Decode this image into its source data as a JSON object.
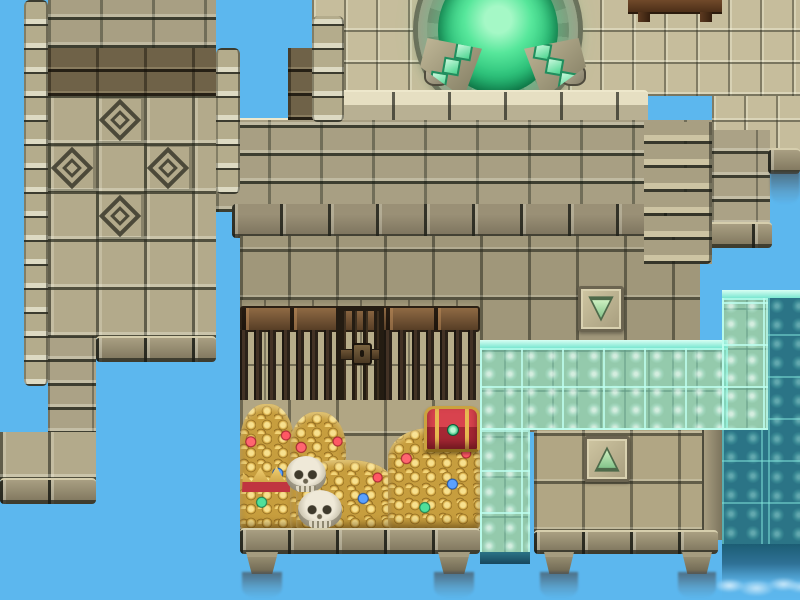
{
  "meta": {
    "scene_type": "rpg-tilemap-ruins",
    "viewport": {
      "width": 800,
      "height": 600
    },
    "tile_size": 48
  },
  "colors": {
    "sky": "#5cb7ee",
    "stone_light": "#c6bd9c",
    "stone_mid": "#a89f83",
    "stone_dark": "#6f6248",
    "wood_beam": "#7a5a38",
    "iron_bar": "#2a2118",
    "water_teal": "#6fe2c8",
    "water_deep": "#2b7486",
    "portal_green": "#2fc47c",
    "gold": "#e2b64d",
    "gem_red": "#e04550",
    "gem_blue": "#4a90e0",
    "gem_green": "#3ad189",
    "arrow_green": "#7fc187"
  },
  "legend": {
    "tilesLight": "light stone floor tiles (upper terrace)",
    "bricks": "stone brick wall",
    "bricksDark": "dark brown brick band",
    "bigTiles": "large square wall tiles",
    "diamondTile": "carved diamond motif tile",
    "roomWall": "sandstone cell wall",
    "floorTiles": "interior stone floor",
    "floorTiles2": "vault / platform floor",
    "woodBeam": "wooden beam above cell bars",
    "bars": "iron cell bars",
    "door": "barred cell door with lock",
    "treasure": "pile of gold coins and gems",
    "skull": "skeleton skull",
    "chest": "red and gold treasure chest",
    "crown": "golden crown",
    "plaque": "stone plaque with transfer arrow",
    "tealLight": "shallow water overlay on stone",
    "tealDark": "deep waterfall water",
    "portalRing": "carved stone portal ring",
    "portalPool": "glowing green portal pool",
    "wedge": "stone pedestal with green crystals",
    "foot": "stone support foot over the void",
    "mistDark": "falling mist"
  },
  "scene": [
    {
      "n": "upper-floor",
      "c": "tilesLight",
      "x": 312,
      "y": 0,
      "w": 488,
      "h": 96,
      "i": false
    },
    {
      "n": "upper-floor-right",
      "c": "tilesLight",
      "x": 712,
      "y": 96,
      "w": 88,
      "h": 58,
      "i": false
    },
    {
      "n": "banquet-table",
      "c": "tableTop",
      "x": 628,
      "y": 0,
      "w": 94,
      "h": 14,
      "i": false
    },
    {
      "n": "table-leg",
      "c": "tableLeg",
      "x": 638,
      "y": 12,
      "w": 12,
      "h": 10,
      "i": false
    },
    {
      "n": "table-leg",
      "c": "tableLeg",
      "x": 700,
      "y": 12,
      "w": 12,
      "h": 10,
      "i": false
    },
    {
      "n": "portal-ring",
      "c": "portalRing",
      "x": 418,
      "y": -54,
      "w": 160,
      "h": 168,
      "i": false
    },
    {
      "n": "portal-pool",
      "c": "portalPool",
      "x": 438,
      "y": -34,
      "w": 120,
      "h": 128,
      "i": true
    },
    {
      "n": "ring-stone",
      "c": "ringBlock",
      "x": 424,
      "y": 64,
      "w": 26,
      "h": 22,
      "i": false
    },
    {
      "n": "ring-stone",
      "c": "ringBlock",
      "x": 448,
      "y": 92,
      "w": 26,
      "h": 20,
      "i": false
    },
    {
      "n": "ring-stone",
      "c": "ringBlock",
      "x": 476,
      "y": 102,
      "w": 28,
      "h": 20,
      "i": false
    },
    {
      "n": "ring-stone",
      "c": "ringBlock",
      "x": 508,
      "y": 102,
      "w": 26,
      "h": 20,
      "i": false
    },
    {
      "n": "ring-stone",
      "c": "ringBlock",
      "x": 538,
      "y": 92,
      "w": 26,
      "h": 20,
      "i": false
    },
    {
      "n": "ring-stone",
      "c": "ringBlock",
      "x": 560,
      "y": 64,
      "w": 26,
      "h": 22,
      "i": false
    },
    {
      "n": "pedestal-left",
      "c": "wedge",
      "d": "left",
      "x": 420,
      "y": 38,
      "w": 62,
      "h": 60,
      "i": false
    },
    {
      "n": "pedestal-right",
      "c": "wedge",
      "d": "right",
      "x": 524,
      "y": 38,
      "w": 62,
      "h": 60,
      "i": false
    },
    {
      "n": "wall-cap",
      "c": "capRow",
      "x": 336,
      "y": 90,
      "w": 312,
      "h": 34,
      "i": false
    },
    {
      "n": "wall-cap-left",
      "c": "capRow",
      "x": 216,
      "y": 118,
      "w": 128,
      "h": 34,
      "i": false
    },
    {
      "n": "wall-bricks",
      "c": "bricks",
      "x": 216,
      "y": 120,
      "w": 496,
      "h": 92,
      "i": false
    },
    {
      "n": "wall-base-cap",
      "c": "darkCap",
      "x": 232,
      "y": 204,
      "w": 480,
      "h": 34,
      "i": false
    },
    {
      "n": "right-column",
      "c": "bricksSmall",
      "x": 712,
      "y": 130,
      "w": 58,
      "h": 96,
      "i": false
    },
    {
      "n": "right-column-ledge",
      "c": "ledgeRow",
      "x": 704,
      "y": 222,
      "w": 68,
      "h": 26,
      "i": false
    },
    {
      "n": "cliff-ledge",
      "c": "ledgeRow",
      "x": 768,
      "y": 148,
      "w": 32,
      "h": 26,
      "i": false
    },
    {
      "n": "ledge-mist",
      "c": "mistDark",
      "x": 770,
      "y": 172,
      "w": 30,
      "h": 32,
      "i": false
    },
    {
      "n": "wall-notch-column",
      "c": "bricksDark",
      "x": 288,
      "y": 48,
      "w": 26,
      "h": 72,
      "i": false
    },
    {
      "n": "terrace-left-trim",
      "c": "trimBlocks",
      "x": 312,
      "y": 16,
      "w": 32,
      "h": 106,
      "i": false
    },
    {
      "n": "room-floor",
      "c": "floorTiles",
      "x": 240,
      "y": 236,
      "w": 472,
      "h": 112,
      "i": false
    },
    {
      "n": "wall-stairs",
      "c": "stairs",
      "x": 644,
      "y": 122,
      "w": 68,
      "h": 142,
      "i": false
    },
    {
      "n": "sky-notch",
      "c": "sky",
      "x": 700,
      "y": 264,
      "w": 28,
      "h": 80,
      "i": false
    },
    {
      "n": "down-arrow-plaque",
      "c": "plaque",
      "d": "down",
      "x": 578,
      "y": 286,
      "w": 46,
      "h": 46,
      "i": true
    },
    {
      "n": "cell-wall",
      "c": "roomWall",
      "x": 240,
      "y": 300,
      "w": 240,
      "h": 106,
      "i": false
    },
    {
      "n": "cell-beam",
      "c": "woodBeam",
      "x": 240,
      "y": 306,
      "w": 240,
      "h": 26,
      "i": false
    },
    {
      "n": "cell-bars",
      "c": "bars",
      "x": 240,
      "y": 330,
      "w": 96,
      "h": 76,
      "i": false
    },
    {
      "n": "cell-bars",
      "c": "bars",
      "x": 384,
      "y": 330,
      "w": 96,
      "h": 76,
      "i": false
    },
    {
      "n": "cell-door",
      "c": "door",
      "x": 336,
      "y": 306,
      "w": 48,
      "h": 100,
      "i": true
    },
    {
      "n": "treasure-floor",
      "c": "floorTiles2",
      "x": 240,
      "y": 400,
      "w": 240,
      "h": 132,
      "i": false
    },
    {
      "n": "gold-pile",
      "c": "treasure",
      "x": 240,
      "y": 404,
      "w": 54,
      "h": 126,
      "i": false
    },
    {
      "n": "gold-pile",
      "c": "treasure",
      "x": 290,
      "y": 412,
      "w": 56,
      "h": 118,
      "i": false
    },
    {
      "n": "gold-pile",
      "c": "treasure",
      "x": 296,
      "y": 460,
      "w": 96,
      "h": 70,
      "i": false
    },
    {
      "n": "gold-pile",
      "c": "treasure",
      "x": 388,
      "y": 428,
      "w": 92,
      "h": 102,
      "i": false
    },
    {
      "n": "crown",
      "c": "crown",
      "x": 242,
      "y": 464,
      "w": 48,
      "h": 28,
      "i": false
    },
    {
      "n": "skull",
      "c": "skull",
      "x": 286,
      "y": 456,
      "w": 40,
      "h": 36,
      "i": false
    },
    {
      "n": "skull",
      "c": "skull",
      "x": 298,
      "y": 490,
      "w": 44,
      "h": 38,
      "i": false
    },
    {
      "n": "treasure-chest",
      "c": "chest",
      "x": 424,
      "y": 406,
      "w": 56,
      "h": 46,
      "i": true
    },
    {
      "n": "treasure-ledge",
      "c": "ledgeRow",
      "x": 240,
      "y": 528,
      "w": 240,
      "h": 26,
      "i": false
    },
    {
      "n": "support-foot",
      "c": "foot",
      "x": 246,
      "y": 552,
      "w": 32,
      "h": 22,
      "i": false
    },
    {
      "n": "support-foot",
      "c": "foot",
      "x": 438,
      "y": 552,
      "w": 32,
      "h": 22,
      "i": false
    },
    {
      "n": "falling-mist",
      "c": "mistDark",
      "x": 242,
      "y": 572,
      "w": 40,
      "h": 26,
      "i": false
    },
    {
      "n": "falling-mist",
      "c": "mistDark",
      "x": 434,
      "y": 572,
      "w": 40,
      "h": 26,
      "i": false
    },
    {
      "n": "water-backing",
      "c": "roomWall",
      "x": 480,
      "y": 344,
      "w": 248,
      "h": 88,
      "i": false
    },
    {
      "n": "water-backing",
      "c": "roomWall",
      "x": 480,
      "y": 430,
      "w": 50,
      "h": 128,
      "i": false
    },
    {
      "n": "water-backing",
      "c": "roomWall",
      "x": 722,
      "y": 298,
      "w": 46,
      "h": 132,
      "i": false
    },
    {
      "n": "water-sheet-edge",
      "c": "tealEdge",
      "x": 480,
      "y": 340,
      "w": 248,
      "h": 10,
      "i": false
    },
    {
      "n": "water-sheet",
      "c": "tealLight",
      "x": 480,
      "y": 348,
      "w": 248,
      "h": 82,
      "i": false
    },
    {
      "n": "water-column",
      "c": "tealLight",
      "x": 480,
      "y": 430,
      "w": 50,
      "h": 126,
      "i": false
    },
    {
      "n": "water-column-base",
      "c": "tealBottom",
      "x": 480,
      "y": 552,
      "w": 50,
      "h": 12,
      "i": false
    },
    {
      "n": "water-right-edge",
      "c": "tealEdge",
      "x": 722,
      "y": 290,
      "w": 78,
      "h": 10,
      "i": false
    },
    {
      "n": "water-right",
      "c": "tealLight",
      "x": 722,
      "y": 298,
      "w": 46,
      "h": 132,
      "i": false
    },
    {
      "n": "water-right-deep",
      "c": "tealDark",
      "x": 768,
      "y": 298,
      "w": 32,
      "h": 248,
      "i": false
    },
    {
      "n": "water-right-lower",
      "c": "tealDark",
      "x": 722,
      "y": 430,
      "w": 46,
      "h": 116,
      "i": false
    },
    {
      "n": "waterfall-mist",
      "c": "waterfallFade",
      "x": 722,
      "y": 544,
      "w": 78,
      "h": 56,
      "i": false
    },
    {
      "n": "ledge-platform",
      "c": "floorTiles2",
      "x": 534,
      "y": 430,
      "w": 184,
      "h": 102,
      "i": false
    },
    {
      "n": "up-arrow-plaque",
      "c": "plaque",
      "d": "up",
      "x": 584,
      "y": 436,
      "w": 46,
      "h": 46,
      "i": true
    },
    {
      "n": "platform-edge",
      "c": "stoneEdge",
      "x": 702,
      "y": 430,
      "w": 20,
      "h": 110,
      "i": false
    },
    {
      "n": "platform-ledge",
      "c": "ledgeRow",
      "x": 534,
      "y": 530,
      "w": 184,
      "h": 24,
      "i": false
    },
    {
      "n": "support-foot",
      "c": "foot",
      "x": 544,
      "y": 552,
      "w": 30,
      "h": 22,
      "i": false
    },
    {
      "n": "support-foot",
      "c": "foot",
      "x": 682,
      "y": 552,
      "w": 30,
      "h": 22,
      "i": false
    },
    {
      "n": "falling-mist",
      "c": "mistDark",
      "x": 540,
      "y": 572,
      "w": 38,
      "h": 26,
      "i": false
    },
    {
      "n": "falling-mist",
      "c": "mistDark",
      "x": 678,
      "y": 572,
      "w": 38,
      "h": 26,
      "i": false
    },
    {
      "n": "tower-left-trim",
      "c": "trimBlocks",
      "x": 24,
      "y": 0,
      "w": 24,
      "h": 386,
      "i": false
    },
    {
      "n": "tower-bricks",
      "c": "bricks",
      "x": 48,
      "y": 0,
      "w": 168,
      "h": 48,
      "i": false
    },
    {
      "n": "tower-dark-band",
      "c": "bricksDark",
      "x": 48,
      "y": 48,
      "w": 168,
      "h": 48,
      "i": false
    },
    {
      "n": "tower-tiles",
      "c": "bigTiles",
      "x": 48,
      "y": 96,
      "w": 168,
      "h": 194,
      "i": false
    },
    {
      "n": "diamond-tile",
      "c": "diamondTile",
      "x": 96,
      "y": 96,
      "w": 48,
      "h": 48,
      "i": false
    },
    {
      "n": "diamond-tile",
      "c": "diamondTile",
      "x": 48,
      "y": 144,
      "w": 48,
      "h": 48,
      "i": false
    },
    {
      "n": "diamond-tile",
      "c": "diamondTile",
      "x": 144,
      "y": 144,
      "w": 48,
      "h": 48,
      "i": false
    },
    {
      "n": "diamond-tile",
      "c": "diamondTile",
      "x": 96,
      "y": 192,
      "w": 48,
      "h": 48,
      "i": false
    },
    {
      "n": "tower-tiles-low",
      "c": "bigTiles",
      "x": 48,
      "y": 288,
      "w": 168,
      "h": 50,
      "i": false
    },
    {
      "n": "tower-right-trim",
      "c": "trimBlocks",
      "x": 216,
      "y": 48,
      "w": 24,
      "h": 146,
      "i": false
    },
    {
      "n": "tower-ledge",
      "c": "ledgeRow",
      "x": 96,
      "y": 336,
      "w": 120,
      "h": 26,
      "i": false
    },
    {
      "n": "tower-stair-column",
      "c": "bricksSmall",
      "x": 48,
      "y": 336,
      "w": 48,
      "h": 146,
      "i": false
    },
    {
      "n": "tower-base",
      "c": "bigTiles",
      "x": 0,
      "y": 432,
      "w": 96,
      "h": 48,
      "i": false
    },
    {
      "n": "tower-base-ledge",
      "c": "ledgeRow",
      "x": 0,
      "y": 478,
      "w": 96,
      "h": 26,
      "i": false
    }
  ]
}
